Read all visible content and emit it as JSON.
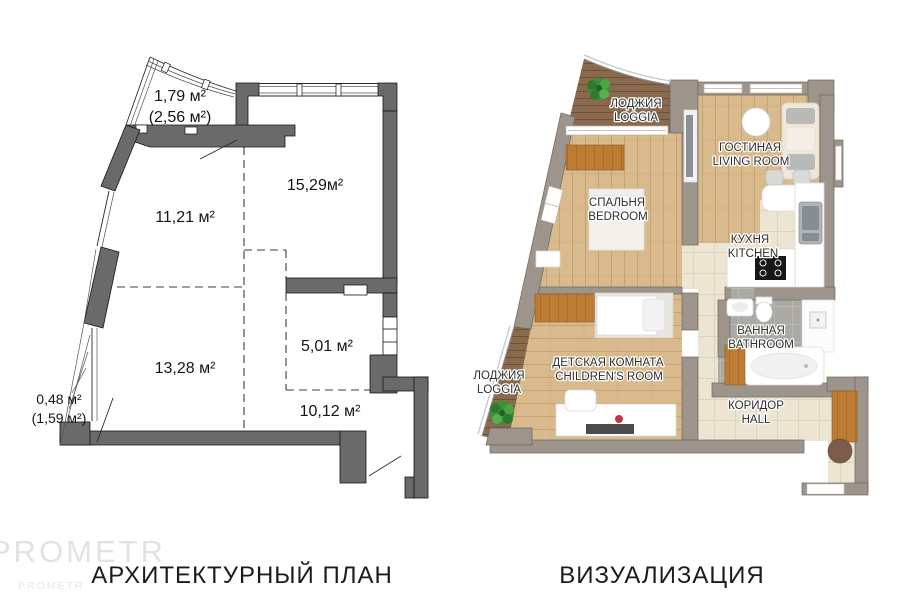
{
  "left_plan": {
    "title": "АРХИТЕКТУРНЫЙ ПЛАН",
    "areas": {
      "loggia_top_1": "1,79 м²",
      "loggia_top_2": "(2,56 м²)",
      "living": "15,29м²",
      "bedroom": "11,21 м²",
      "kitchen": "5,01 м²",
      "children": "13,28 м²",
      "hall": "10,12 м²",
      "loggia_left_1": "0,48 м²",
      "loggia_left_2": "(1,59 м²)"
    }
  },
  "right_plan": {
    "title": "ВИЗУАЛИЗАЦИЯ",
    "rooms": {
      "loggia_top": {
        "ru": "ЛОДЖИЯ",
        "en": "LOGGIA"
      },
      "living": {
        "ru": "ГОСТИНАЯ",
        "en": "LIVING ROOM"
      },
      "bedroom": {
        "ru": "СПАЛЬНЯ",
        "en": "BEDROOM"
      },
      "kitchen": {
        "ru": "КУХНЯ",
        "en": "KITCHEN"
      },
      "bathroom": {
        "ru": "ВАННАЯ",
        "en": "BATHROOM"
      },
      "children": {
        "ru": "ДЕТСКАЯ КОМНАТА",
        "en": "CHILDREN'S ROOM"
      },
      "loggia_left": {
        "ru": "ЛОДЖИЯ",
        "en": "LOGGIA"
      },
      "hall": {
        "ru": "КОРИДОР",
        "en": "HALL"
      }
    }
  },
  "watermark": {
    "line1": "PROMETR",
    "line2": "PROMETR"
  },
  "colors": {
    "left_wall": "#6a6a6a",
    "right_wall": "#9d948b",
    "wood_floor": "#d9ba8d",
    "loggia_wood": "#8a6a4e",
    "hall_tile": "#ece5d2",
    "bath_tile": "#aaa9a3",
    "wardrobe_orange": "#bd7c34",
    "plant_green": "#3e8d3a"
  }
}
